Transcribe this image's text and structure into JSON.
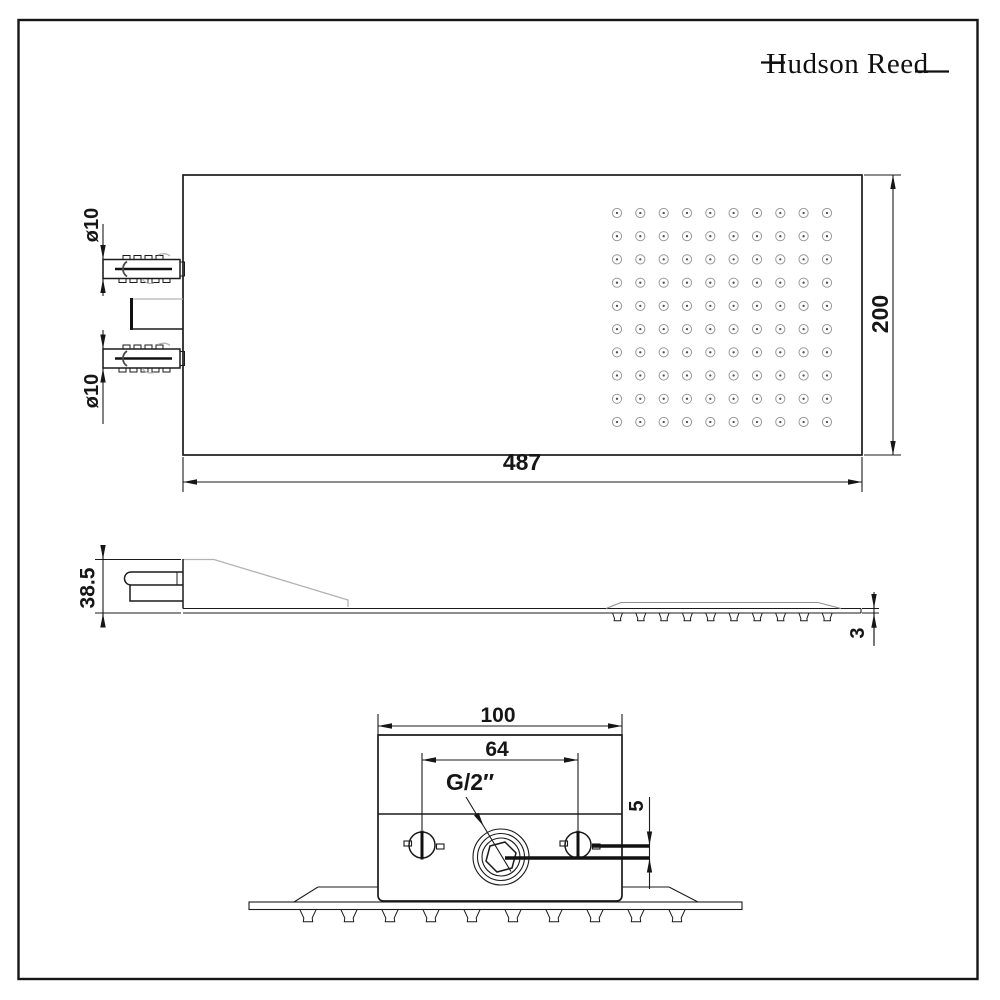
{
  "logo": {
    "text": "Hudson Reed"
  },
  "colors": {
    "line": "#161616",
    "light_line": "#b3b3b3",
    "background": "#ffffff"
  },
  "views": {
    "top": {
      "name": "top-plan-view",
      "label_width": "487",
      "label_height": "200",
      "label_inlet_top": "ø10",
      "label_inlet_bottom": "ø10",
      "nozzle_grid": {
        "rows": 10,
        "cols": 10
      }
    },
    "side": {
      "name": "side-profile-view",
      "label_height": "38.5",
      "label_plate_thickness": "3",
      "nozzle_count": 10
    },
    "end": {
      "name": "end-section-view",
      "label_body_width": "100",
      "label_inlet_spacing": "64",
      "label_thread": "G/2″",
      "label_offset": "5",
      "nozzle_count": 10
    }
  }
}
